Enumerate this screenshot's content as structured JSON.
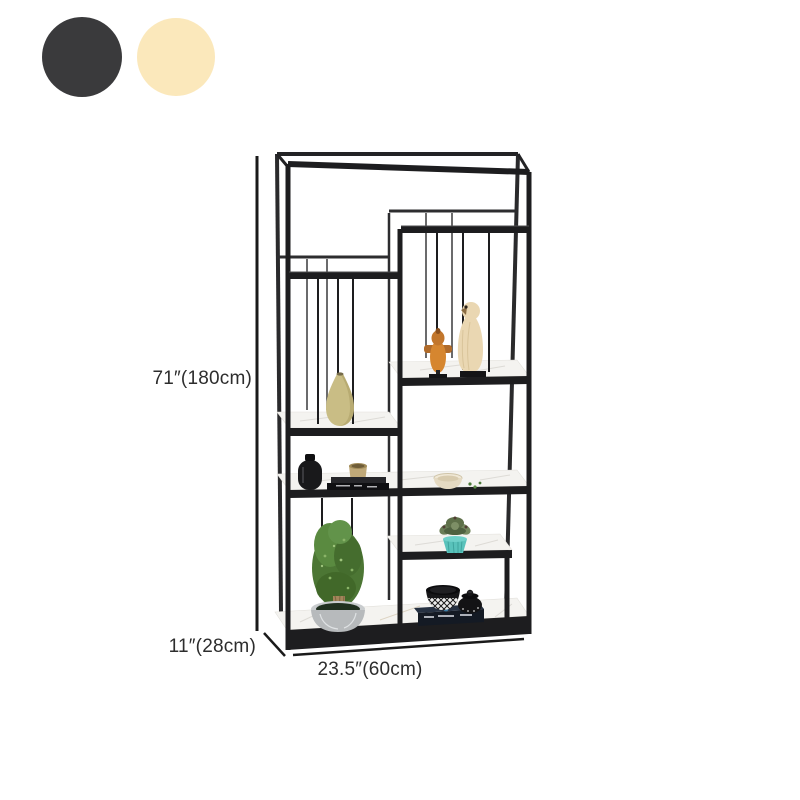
{
  "color_swatches": [
    {
      "name": "charcoal-black",
      "color": "#3a3a3c"
    },
    {
      "name": "cream-yellow",
      "color": "#fbe8bb"
    }
  ],
  "dimension_labels": {
    "height": "71″(180cm)",
    "depth": "11″(28cm)",
    "width": "23.5″(60cm)"
  },
  "illustration": {
    "subject": "black-metal-etagere-bookshelf",
    "frame_color": "#1d1d1f",
    "shelf_surface_color": "#f4f3f0",
    "dimension_line_color": "#1a1a1a",
    "decor_items": [
      "tan-vase",
      "wooden-bird-figurines",
      "black-vase",
      "stacked-books",
      "tan-cup",
      "cream-bowl",
      "topiary-plant-in-gray-pot",
      "succulent-in-teal-pot",
      "black-bowl-set-on-book"
    ]
  },
  "label_text_color": "#2d2d2d"
}
